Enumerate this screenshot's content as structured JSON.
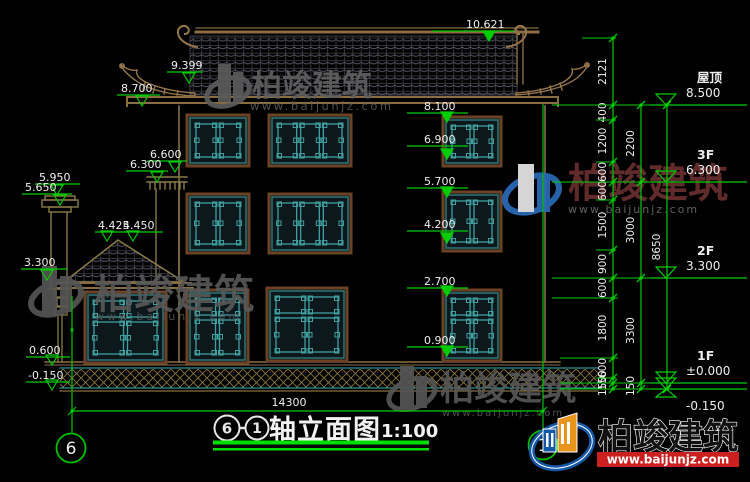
{
  "watermark": {
    "brand": "柏竣建筑",
    "url": "www.baijunjz.com"
  },
  "logo_block": {
    "brand": "柏竣建筑",
    "url": "www.baijunjz.com"
  },
  "title": {
    "axis_from": "6",
    "axis_to": "1",
    "name": "轴立面图",
    "scale": "1:100"
  },
  "axis_bubbles": {
    "left": "6",
    "right": "1"
  },
  "dimensions": {
    "total_width": "14300",
    "chain_inner": [
      "2121",
      "400",
      "1200",
      "600",
      "600",
      "1500",
      "900",
      "600",
      "1800",
      "600",
      "150",
      "150"
    ],
    "chain_inner_ticks": [
      38,
      105,
      120,
      162,
      182,
      200,
      250,
      278,
      298,
      358,
      378,
      383,
      389
    ],
    "chain_floors": [
      "2200",
      "3000",
      "3300",
      "150"
    ],
    "chain_floors_ticks": [
      105,
      182,
      278,
      383,
      389
    ],
    "chain_overall": [
      "8650"
    ],
    "chain_overall_ticks": [
      105,
      389
    ]
  },
  "floor_levels": [
    {
      "floor": "屋顶",
      "elevation": "8.500",
      "y": 105
    },
    {
      "floor": "3F",
      "elevation": "6.300",
      "y": 182
    },
    {
      "floor": "2F",
      "elevation": "3.300",
      "y": 278
    },
    {
      "floor": "1F",
      "elevation": "±0.000",
      "y": 383
    },
    {
      "floor": "",
      "elevation": "-0.150",
      "y": 389
    }
  ],
  "elevation_markers": [
    {
      "label": "10.621",
      "x": 466,
      "y": 28,
      "lx1": 432,
      "lx2": 514,
      "ax": 489,
      "ay": 41,
      "filled": true
    },
    {
      "label": "9.399",
      "x": 171,
      "y": 69,
      "lx1": 167,
      "lx2": 203,
      "ax": 189,
      "ay": 83,
      "filled": false
    },
    {
      "label": "8.700",
      "x": 121,
      "y": 92,
      "lx1": 117,
      "lx2": 160,
      "ax": 142,
      "ay": 106,
      "filled": false
    },
    {
      "label": "6.600",
      "x": 150,
      "y": 158,
      "lx1": 147,
      "lx2": 187,
      "ax": 175,
      "ay": 172,
      "filled": false
    },
    {
      "label": "6.300",
      "x": 130,
      "y": 168,
      "lx1": 126,
      "lx2": 168,
      "ax": 157,
      "ay": 182,
      "filled": false
    },
    {
      "label": "5.950",
      "x": 39,
      "y": 181,
      "lx1": 35,
      "lx2": 80,
      "ax": 57,
      "ay": 195,
      "filled": false
    },
    {
      "label": "5.650",
      "x": 25,
      "y": 191,
      "lx1": 22,
      "lx2": 72,
      "ax": 60,
      "ay": 205,
      "filled": false
    },
    {
      "label": "4.425",
      "x": 98,
      "y": 229,
      "lx1": 95,
      "lx2": 163,
      "ax": 107,
      "ay": 241,
      "filled": false
    },
    {
      "label": "4.450",
      "x": 123,
      "y": 229,
      "lx1": 0,
      "lx2": 0,
      "ax": 133,
      "ay": 241,
      "filled": false
    },
    {
      "label": "3.300",
      "x": 24,
      "y": 266,
      "lx1": 21,
      "lx2": 67,
      "ax": 47,
      "ay": 280,
      "filled": false
    },
    {
      "label": "0.600",
      "x": 29,
      "y": 354,
      "lx1": 26,
      "lx2": 70,
      "ax": 52,
      "ay": 365,
      "filled": false
    },
    {
      "label": "-0.150",
      "x": 28,
      "y": 379,
      "lx1": 26,
      "lx2": 70,
      "ax": 52,
      "ay": 390,
      "filled": false
    },
    {
      "label": "8.100",
      "x": 424,
      "y": 110,
      "lx1": 407,
      "lx2": 468,
      "ax": 447,
      "ay": 122,
      "filled": true
    },
    {
      "label": "6.900",
      "x": 424,
      "y": 143,
      "lx1": 407,
      "lx2": 468,
      "ax": 447,
      "ay": 159,
      "filled": true
    },
    {
      "label": "5.700",
      "x": 424,
      "y": 185,
      "lx1": 407,
      "lx2": 468,
      "ax": 447,
      "ay": 197,
      "filled": true
    },
    {
      "label": "4.200",
      "x": 424,
      "y": 228,
      "lx1": 407,
      "lx2": 468,
      "ax": 447,
      "ay": 243,
      "filled": true
    },
    {
      "label": "2.700",
      "x": 424,
      "y": 285,
      "lx1": 407,
      "lx2": 468,
      "ax": 447,
      "ay": 296,
      "filled": true
    },
    {
      "label": "0.900",
      "x": 424,
      "y": 344,
      "lx1": 407,
      "lx2": 468,
      "ax": 447,
      "ay": 356,
      "filled": true
    }
  ],
  "colors": {
    "dim_green": "#00cd00",
    "line_tan": "#8a6d42",
    "tile_line": "#46465a",
    "window_teal": "#3fa0a0",
    "window_frame": "#6b4226",
    "text_white": "#eeeeee",
    "watermark_gray": "#5f5f5f",
    "watermark_red": "#6a2f2f",
    "logo_blue": "#1558a8",
    "logo_orange": "#e8951e",
    "banner_red": "#cc1f1f",
    "hatch_tan": "#8a7840",
    "ground_teal": "#2f8f8f"
  }
}
